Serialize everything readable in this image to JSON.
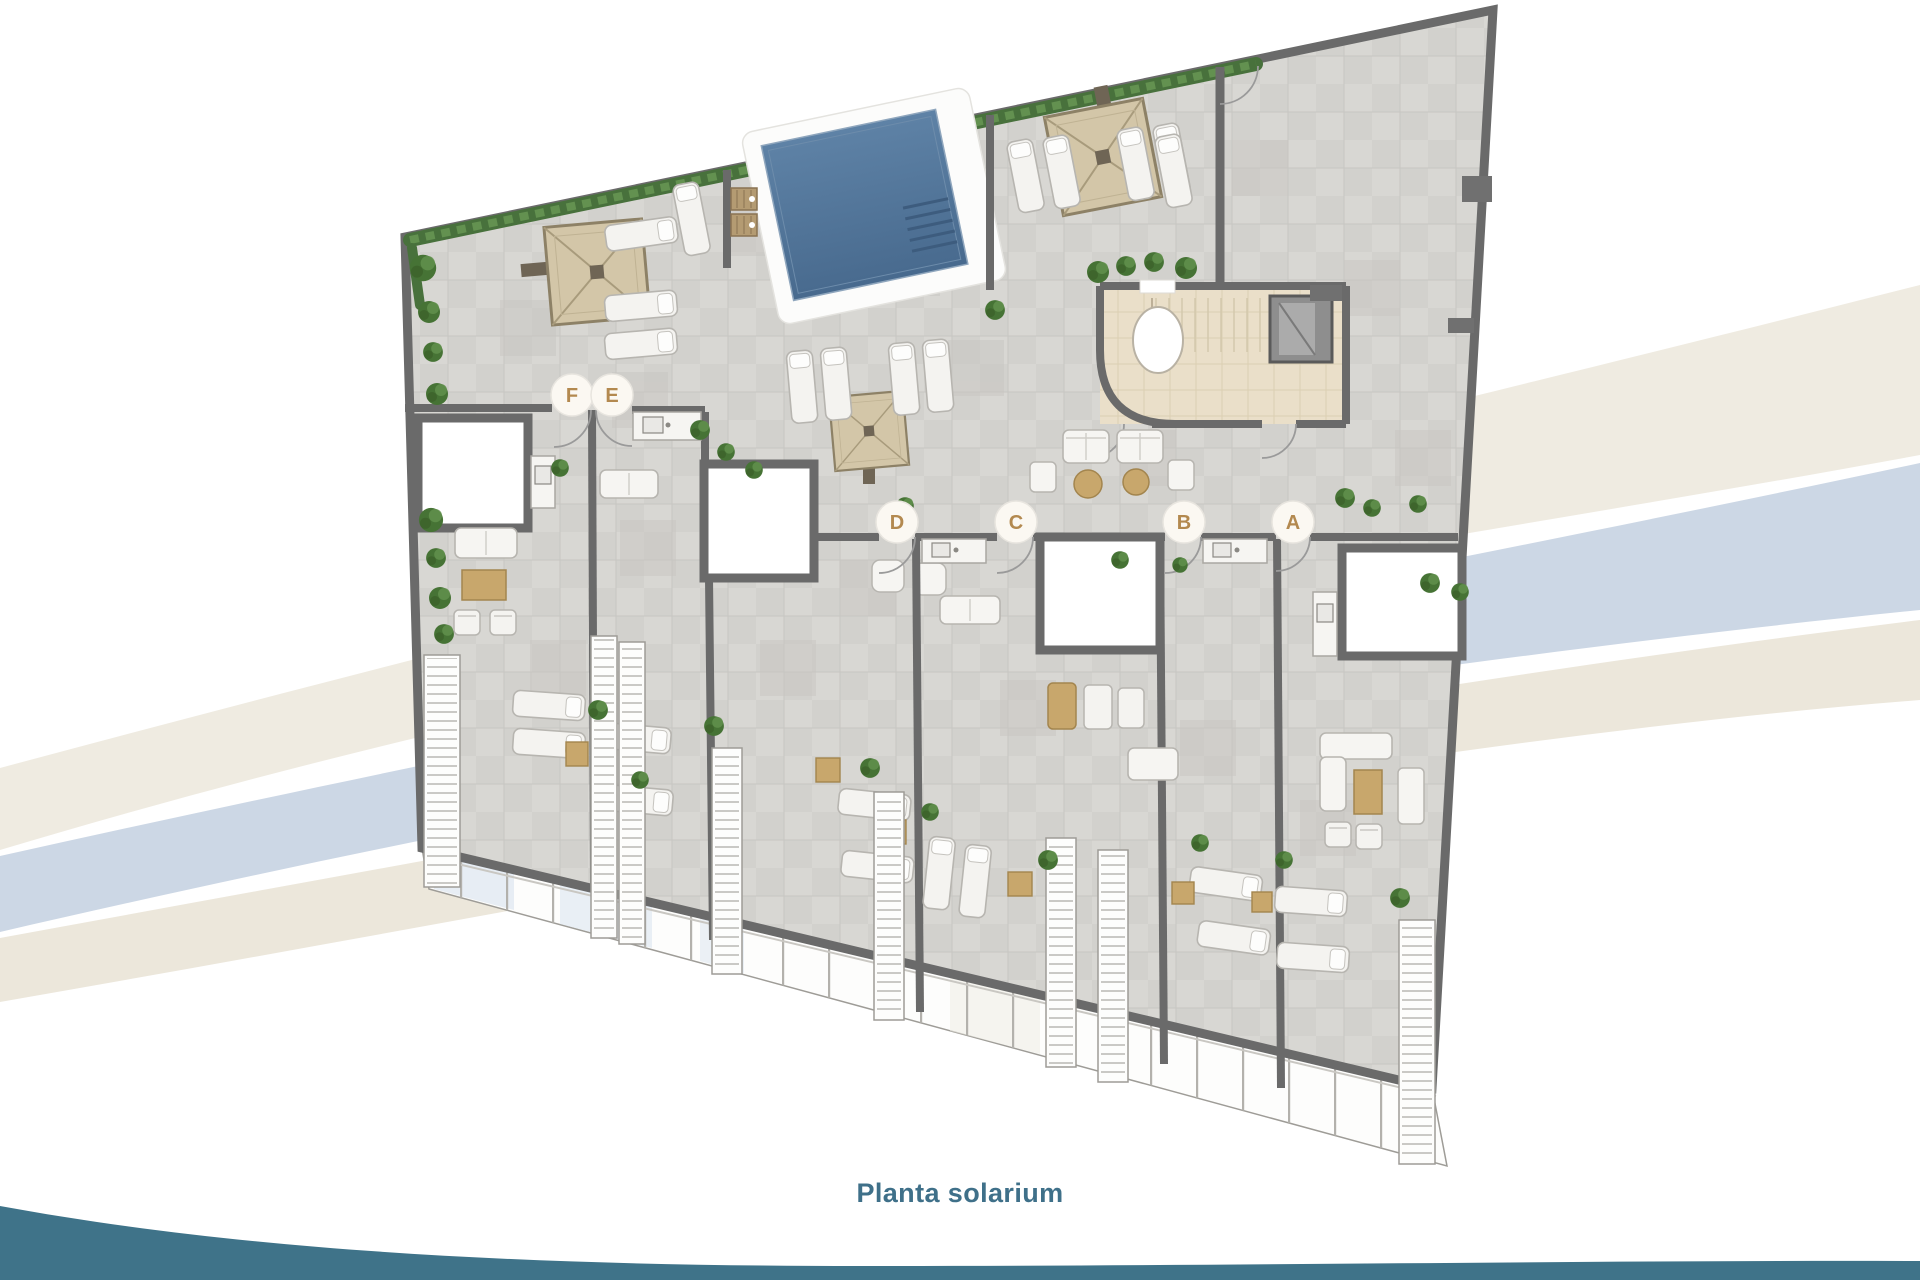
{
  "page": {
    "background_color": "#ffffff"
  },
  "plan": {
    "caption": "Planta solarium",
    "caption_color": "#3f7089",
    "unit_markers": [
      {
        "label": "F"
      },
      {
        "label": "E"
      },
      {
        "label": "D"
      },
      {
        "label": "C"
      },
      {
        "label": "B"
      },
      {
        "label": "A"
      }
    ],
    "marker_letter_color": "#b3894f",
    "colors": {
      "wall": "#6a6a6a",
      "tile": "#d8d7d3",
      "tile_alt": "#cbcac6",
      "pool_water": "#53779c",
      "pool_deck": "#fcfcfb",
      "pergola": "#d3c6a8",
      "core_floor": "#eadfc9",
      "hedge": "#48713c",
      "lounger": "#f4f3f0",
      "table_wood": "#c8a76c",
      "swoosh_beige": "#efebe1",
      "swoosh_blue": "#ccd7e5",
      "footer_wave": "#3f7389"
    }
  }
}
